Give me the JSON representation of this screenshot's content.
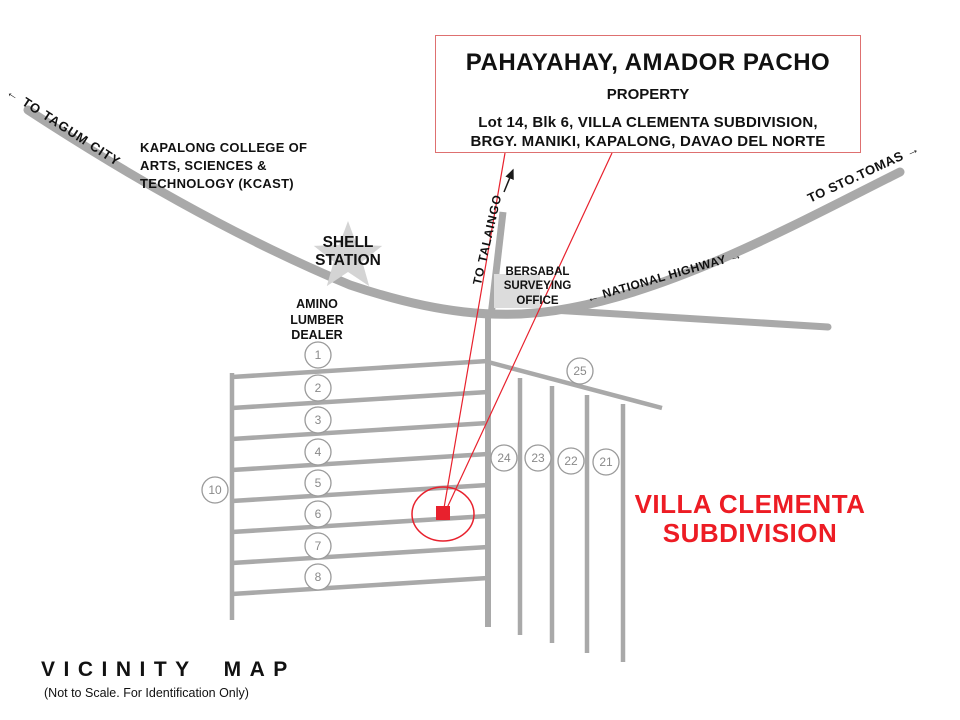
{
  "title_box": {
    "line1": "PAHAYAHAY, AMADOR PACHO",
    "line2": "PROPERTY",
    "line3": "Lot 14, Blk 6, VILLA CLEMENTA SUBDIVISION,",
    "line4": "BRGY. MANIKI, KAPALONG, DAVAO DEL NORTE"
  },
  "landmarks": {
    "college": "KAPALONG COLLEGE OF\nARTS, SCIENCES &\nTECHNOLOGY (KCAST)",
    "shell_station": "SHELL\nSTATION",
    "lumber_dealer": "AMINO\nLUMBER\nDEALER",
    "surveying_office": "BERSABAL\nSURVEYING\nOFFICE"
  },
  "roads": {
    "to_tagum": "TO TAGUM CITY",
    "to_sto_tomas": "TO STO.TOMAS",
    "national_highway": "NATIONAL HIGHWAY",
    "to_talaingo": "TO  TALAINGO"
  },
  "icons": {
    "arrow_left": "←",
    "arrow_right": "→"
  },
  "subdivision": {
    "name": "VILLA CLEMENTA\nSUBDIVISION",
    "lot_markers": [
      "1",
      "2",
      "3",
      "4",
      "5",
      "6",
      "7",
      "8",
      "10",
      "25",
      "24",
      "23",
      "22",
      "21"
    ]
  },
  "footer": {
    "title": "VICINITY MAP",
    "subtitle": "(Not to Scale. For Identification Only)"
  },
  "colors": {
    "road_gray": "#a9a9a9",
    "marker_red": "#e8212d",
    "subdivision_text_red": "#ed1c24",
    "title_box_border": "#de7070"
  }
}
